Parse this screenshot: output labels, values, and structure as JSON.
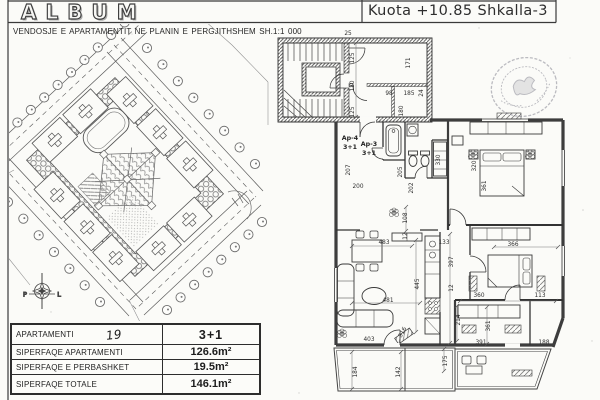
{
  "page": {
    "paper_color": "#fbfbf8",
    "ink_color": "#333333"
  },
  "header": {
    "logo_text": "ALBUM",
    "elevation_label": "Kuota +10.85 Shkalla-3",
    "subtitle": "VENDOSJE E APARTAMENTIT NE PLANIN E PERGJITHSHEM  SH.1:1 000"
  },
  "site_plan": {
    "compass": {
      "west_label": "P",
      "east_label": "L"
    }
  },
  "floor_plan": {
    "unit_labels": [
      {
        "t": "Ap-4",
        "x": 350,
        "y": 140
      },
      {
        "t": "3+1",
        "x": 350,
        "y": 149
      },
      {
        "t": "Ap-3",
        "x": 369,
        "y": 146
      },
      {
        "t": "3+1",
        "x": 369,
        "y": 155
      }
    ],
    "dimensions": [
      {
        "t": "125",
        "x": 354,
        "y": 58,
        "r": -90
      },
      {
        "t": "120",
        "x": 354,
        "y": 86,
        "r": -90
      },
      {
        "t": "125",
        "x": 354,
        "y": 112,
        "r": -90
      },
      {
        "t": "25",
        "x": 348,
        "y": 35,
        "r": 0
      },
      {
        "t": "171",
        "x": 410,
        "y": 63,
        "r": -90
      },
      {
        "t": "98",
        "x": 389,
        "y": 95,
        "r": 0
      },
      {
        "t": "185",
        "x": 409,
        "y": 95,
        "r": 0
      },
      {
        "t": "180",
        "x": 403,
        "y": 111,
        "r": -90
      },
      {
        "t": "24",
        "x": 423,
        "y": 93,
        "r": -90
      },
      {
        "t": "207",
        "x": 350,
        "y": 170,
        "r": -90
      },
      {
        "t": "200",
        "x": 358,
        "y": 188,
        "r": 0
      },
      {
        "t": "205",
        "x": 402,
        "y": 172,
        "r": -90
      },
      {
        "t": "202",
        "x": 413,
        "y": 188,
        "r": -90
      },
      {
        "t": "330",
        "x": 440,
        "y": 160,
        "r": -90
      },
      {
        "t": "320",
        "x": 476,
        "y": 166,
        "r": -90
      },
      {
        "t": "361",
        "x": 486,
        "y": 186,
        "r": -90
      },
      {
        "t": "108",
        "x": 407,
        "y": 218,
        "r": -90
      },
      {
        "t": "12",
        "x": 407,
        "y": 236,
        "r": -90
      },
      {
        "t": "483",
        "x": 384,
        "y": 244,
        "r": 0
      },
      {
        "t": "133",
        "x": 444,
        "y": 244,
        "r": 0
      },
      {
        "t": "397",
        "x": 453,
        "y": 262,
        "r": -90
      },
      {
        "t": "12",
        "x": 453,
        "y": 288,
        "r": -90
      },
      {
        "t": "445",
        "x": 419,
        "y": 284,
        "r": -90
      },
      {
        "t": "481",
        "x": 388,
        "y": 302,
        "r": 0
      },
      {
        "t": "366",
        "x": 513,
        "y": 246,
        "r": 0
      },
      {
        "t": "214",
        "x": 460,
        "y": 320,
        "r": -90
      },
      {
        "t": "403",
        "x": 369,
        "y": 341,
        "r": 0
      },
      {
        "t": "316",
        "x": 404,
        "y": 333,
        "r": -62
      },
      {
        "t": "184",
        "x": 357,
        "y": 372,
        "r": -90
      },
      {
        "t": "142",
        "x": 400,
        "y": 372,
        "r": -90
      },
      {
        "t": "175",
        "x": 447,
        "y": 361,
        "r": -90
      },
      {
        "t": "361",
        "x": 490,
        "y": 326,
        "r": -90
      },
      {
        "t": "360",
        "x": 479,
        "y": 297,
        "r": 0
      },
      {
        "t": "113",
        "x": 540,
        "y": 297,
        "r": 0
      },
      {
        "t": "391",
        "x": 481,
        "y": 344,
        "r": 0
      },
      {
        "t": "188",
        "x": 544,
        "y": 344,
        "r": 0
      }
    ]
  },
  "info_table": {
    "rows": [
      {
        "label": "APARTAMENTI",
        "note": "19",
        "value": "3+1"
      },
      {
        "label": "SIPERFAQE APARTAMENTI",
        "note": "",
        "value": "126.6m²"
      },
      {
        "label": "SIPERFAQE E PERBASHKET",
        "note": "",
        "value": "19.5m²"
      },
      {
        "label": "SIPERFAQE TOTALE",
        "note": "",
        "value": "146.1m²"
      }
    ]
  }
}
